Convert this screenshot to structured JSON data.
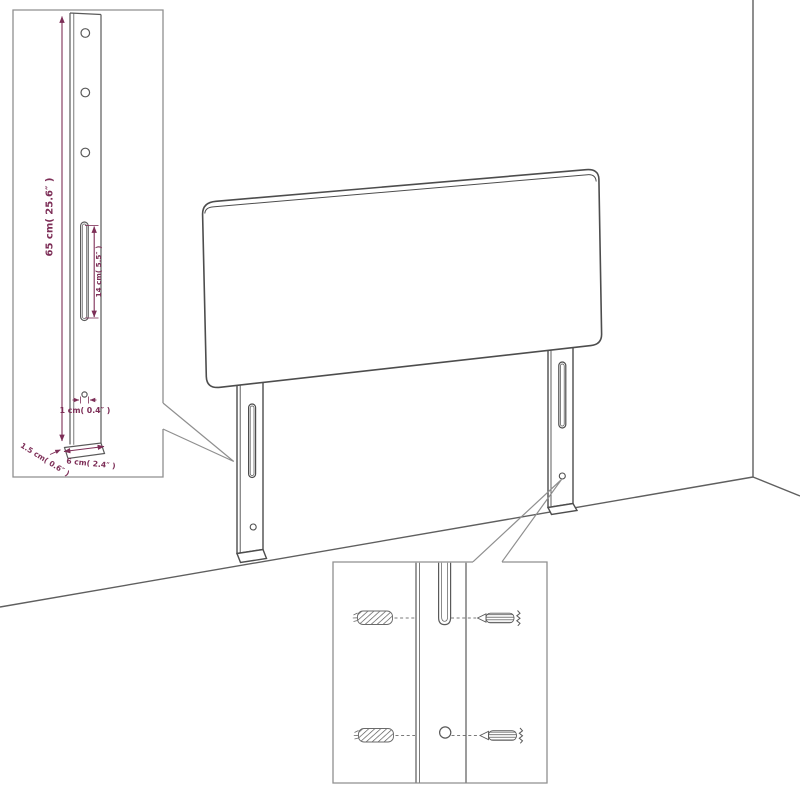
{
  "scene": {
    "background_color": "#ffffff",
    "line_color": "#4d4d4d",
    "box_line_color": "#8f8f8f",
    "accent_color": "#7d2e57"
  },
  "dimension_labels": {
    "bracket_height": "65 cm( 25.6″ )",
    "slot_length": "14 cm( 5.5″ )",
    "hole_size": "1 cm( 0.4″ )",
    "bracket_thickness": "1.5 cm( 0.6″ )",
    "bracket_width": "6 cm( 2.4″ )"
  },
  "icons": {
    "wall_plug": "wall-plug-icon",
    "screw": "screw-icon"
  }
}
